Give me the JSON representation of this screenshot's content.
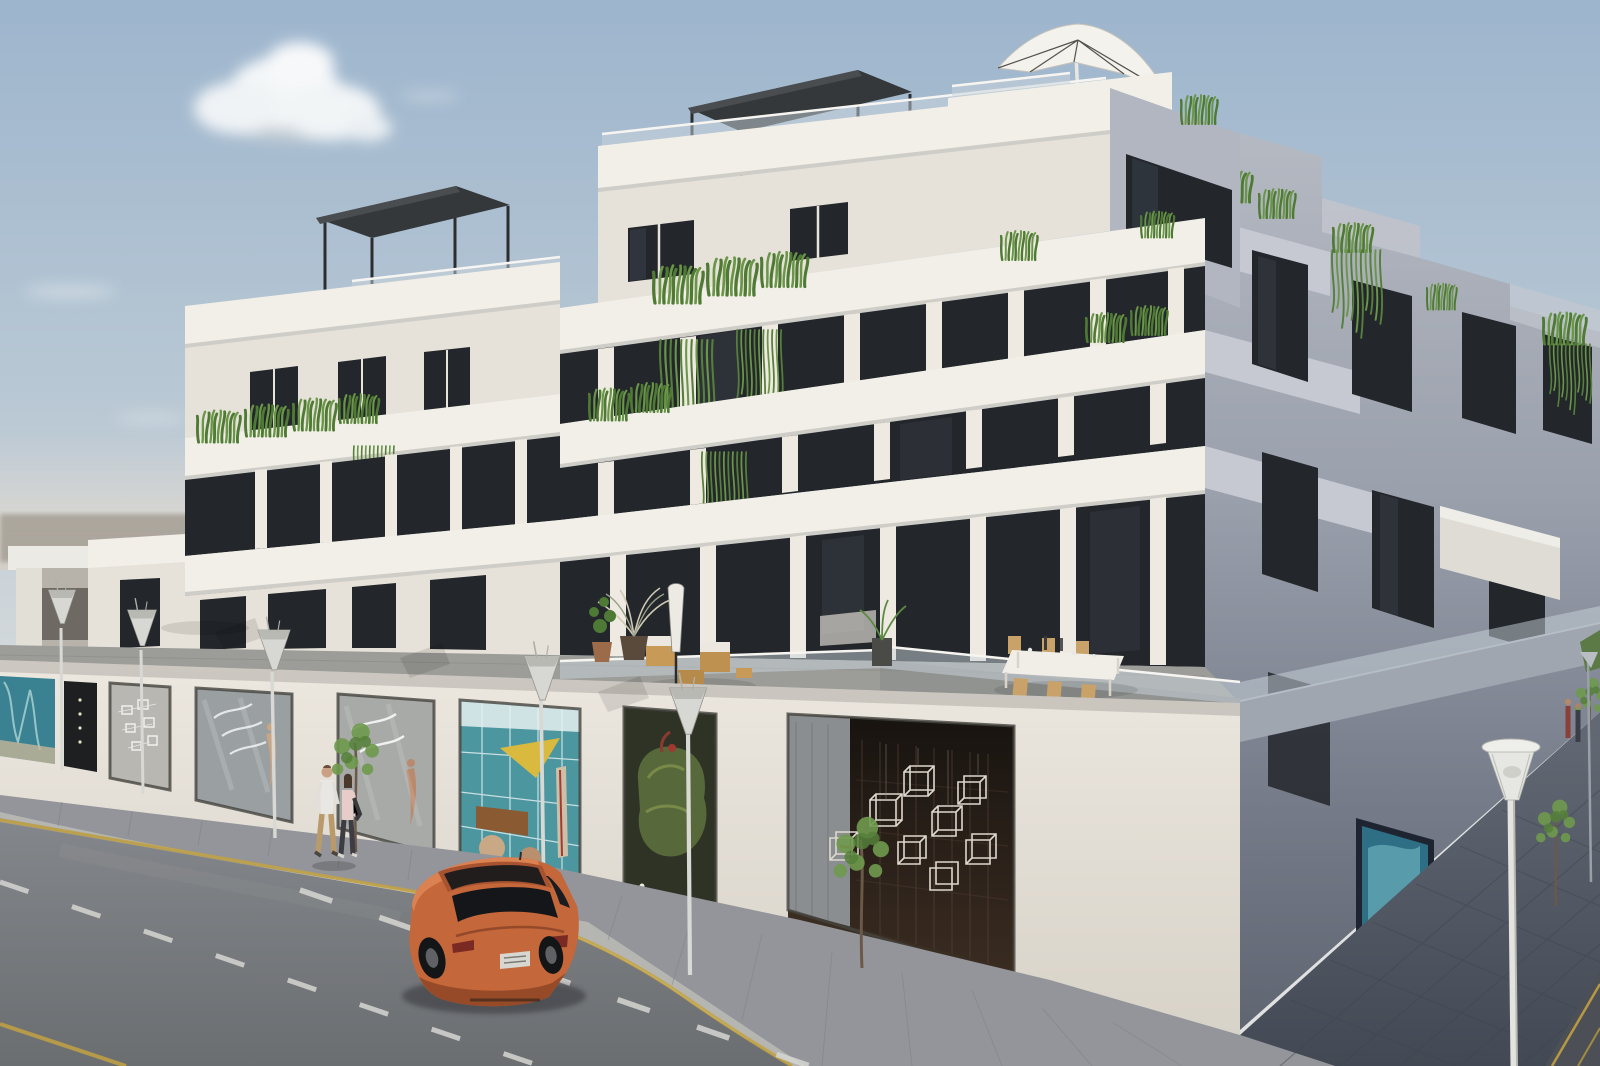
{
  "meta": {
    "caption": "Daytime 3D architectural rendering of a modern white stepped apartment building with rooftop pergolas, a cantilever parasol, glass balustrades, planted terraces and ground-floor gallery storefronts; an orange hatchback drives on the street past street lamps, young trees and two pedestrians.",
    "type": "architectural-render",
    "time_of_day": "day",
    "width_px": 1600,
    "height_px": 1066
  },
  "palette": {
    "sky_top": "#9db5cd",
    "sky_horizon": "#e0e1e1",
    "facade_sunlit": "#e7e2d9",
    "facade_slab": "#f2efe8",
    "facade_shadow": "#9299a4",
    "terrace_floor": "#9a9a96",
    "road": "#7c7f82",
    "sidewalk": "#94959a",
    "sidewalk_shadow": "#555b66",
    "yellow_line": "#c2a242",
    "dash_white": "#d6d6d2",
    "glass_dark": "#23262b",
    "car_orange": "#c4673a",
    "teal_art": "#3a8292",
    "moss_art": "#57683a",
    "cube_shop_bg": "#231d18",
    "plant_green": "#4e7a34"
  },
  "scene": {
    "sky": {
      "clouds_main": 1,
      "cloud_wisps": 3
    },
    "building": {
      "style": "modern stepped apartment block, corner view",
      "floors_visible": 6,
      "features": [
        "two dark rooftop pergolas",
        "white cantilever parasol on roof terrace",
        "glass balustrades",
        "grass planter boxes",
        "hanging vines",
        "corner terrace with outdoor dining",
        "dark framed floor-to-ceiling glazing",
        "shadowed side facade"
      ]
    },
    "storefronts": [
      {
        "name": "teal-gallery-far-left",
        "art": "teal beach artwork"
      },
      {
        "name": "dark-boutique",
        "art": "spotlit dark interior"
      },
      {
        "name": "line-art-gallery",
        "art": "white wire wall diagram"
      },
      {
        "name": "feather-gallery",
        "art": "white feather mobile and mannequin"
      },
      {
        "name": "sculpture-gallery",
        "art": "white hanging sculpture and figure"
      },
      {
        "name": "beach-shop",
        "art": "yellow kite, surfboard, wooden bench, beach balls"
      },
      {
        "name": "moss-gallery",
        "art": "green moss flamingo sculpture with red accents"
      },
      {
        "name": "cube-installation-hall",
        "art": "white wireframe cubes on dark brick wall"
      },
      {
        "name": "side-street-gallery",
        "art": "blue palm painting"
      }
    ],
    "terrace_furniture": [
      "white dining table with six wooden chairs and glassware",
      "wicker lounge chairs with white cushions",
      "closed parasol",
      "open white parasol on far terrace",
      "potted palm and green plants",
      "corner planter"
    ],
    "street": {
      "lamps_foreground": 6,
      "lamps_distant": 1,
      "trees_young": 4,
      "markings": [
        "yellow curb line",
        "two dashed white lane lines",
        "yellow edge line bottom left",
        "side street yellow lines"
      ]
    },
    "car": {
      "type": "3-door hatchback",
      "color": "#c4673a",
      "heading": "driving away, rear three-quarter view",
      "license_plate": "illegible"
    },
    "pedestrians": {
      "foreground_couple": 2,
      "distant_pair": 2
    }
  }
}
